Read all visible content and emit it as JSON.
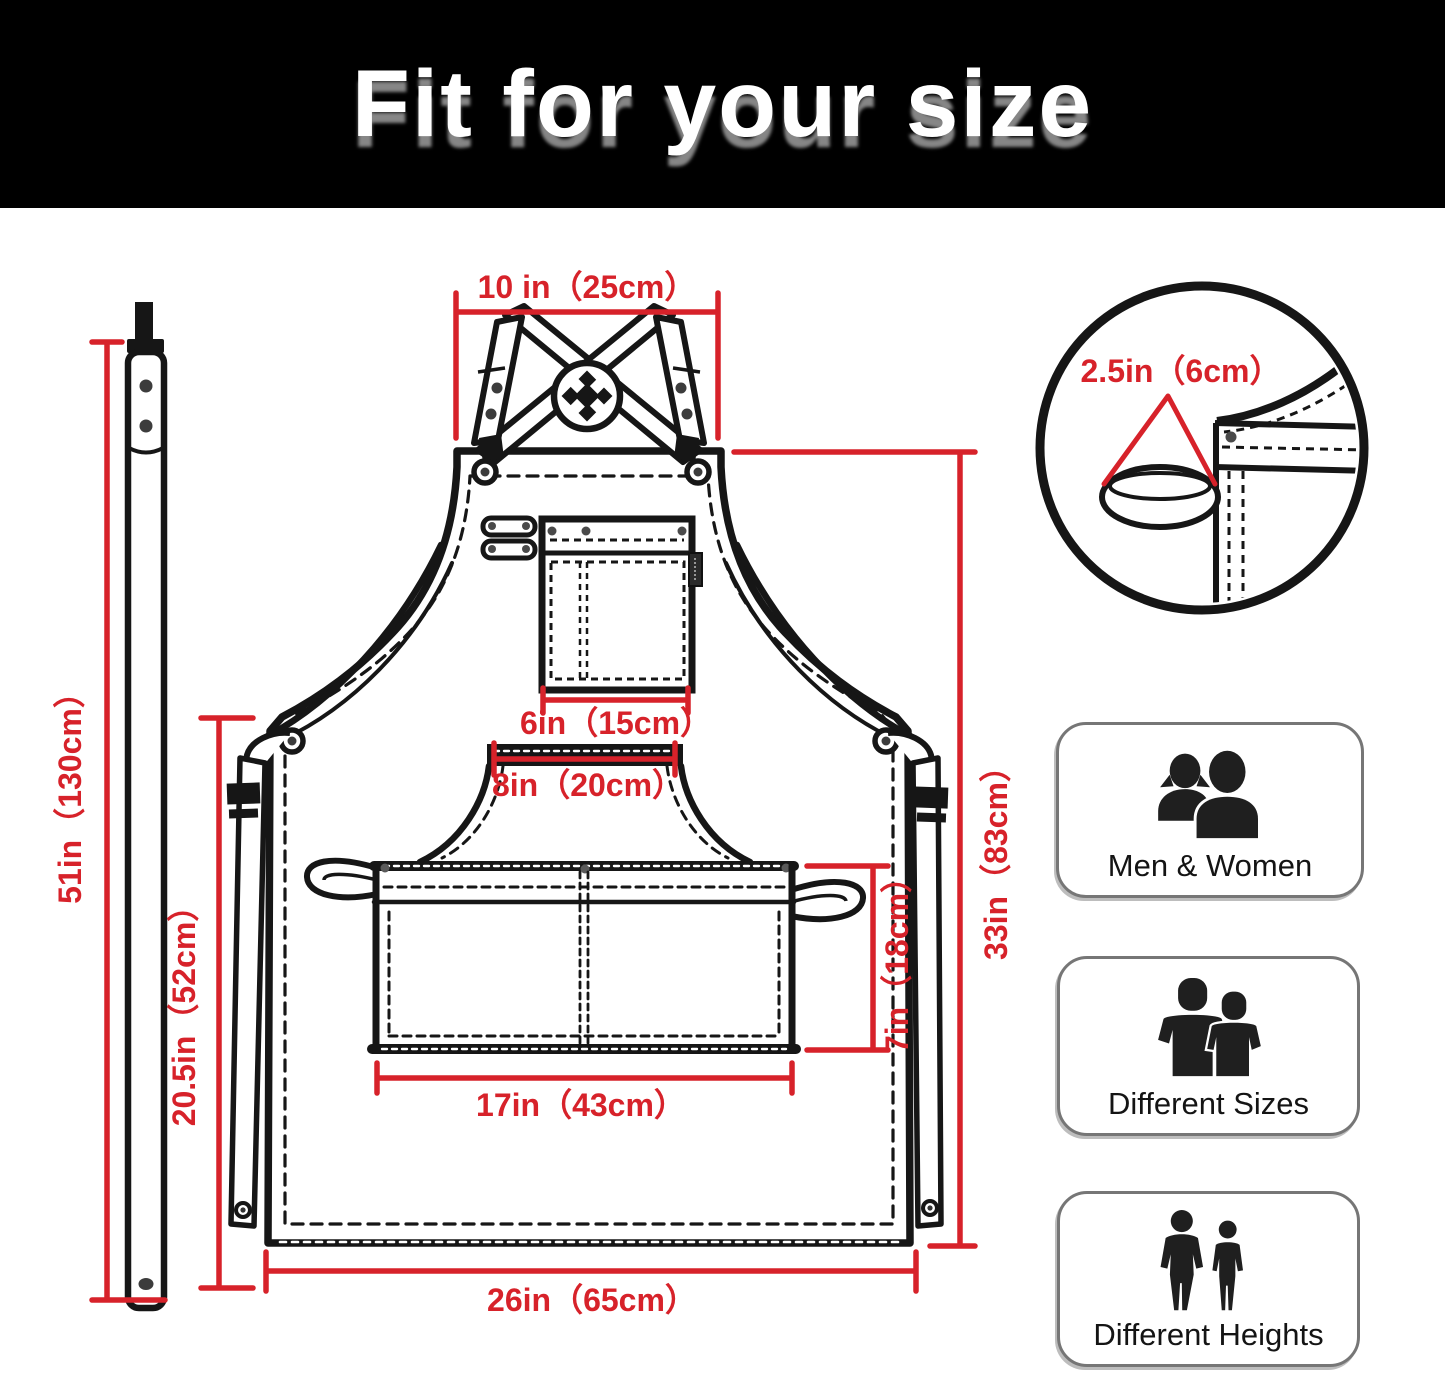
{
  "header": {
    "title": "Fit for your size"
  },
  "colors": {
    "dimension_red": "#d7222a",
    "outline_black": "#161616",
    "header_bg": "#000000"
  },
  "diagram": {
    "dimensions": {
      "strap_top_width": "10 in（25cm）",
      "detail_loop_width": "2.5in（6cm）",
      "chest_pocket_width": "6in（15cm）",
      "waist_panel_top_width": "8in（20cm）",
      "waist_pocket_width": "17in（43cm）",
      "waist_pocket_height": "7in（18cm）",
      "body_height": "33in（83cm）",
      "body_width": "26in（65cm）",
      "strap_length": "51in（130cm）",
      "side_height": "20.5in（52cm）"
    }
  },
  "badges": [
    {
      "label": "Men & Women"
    },
    {
      "label": "Different Sizes"
    },
    {
      "label": "Different Heights"
    }
  ]
}
